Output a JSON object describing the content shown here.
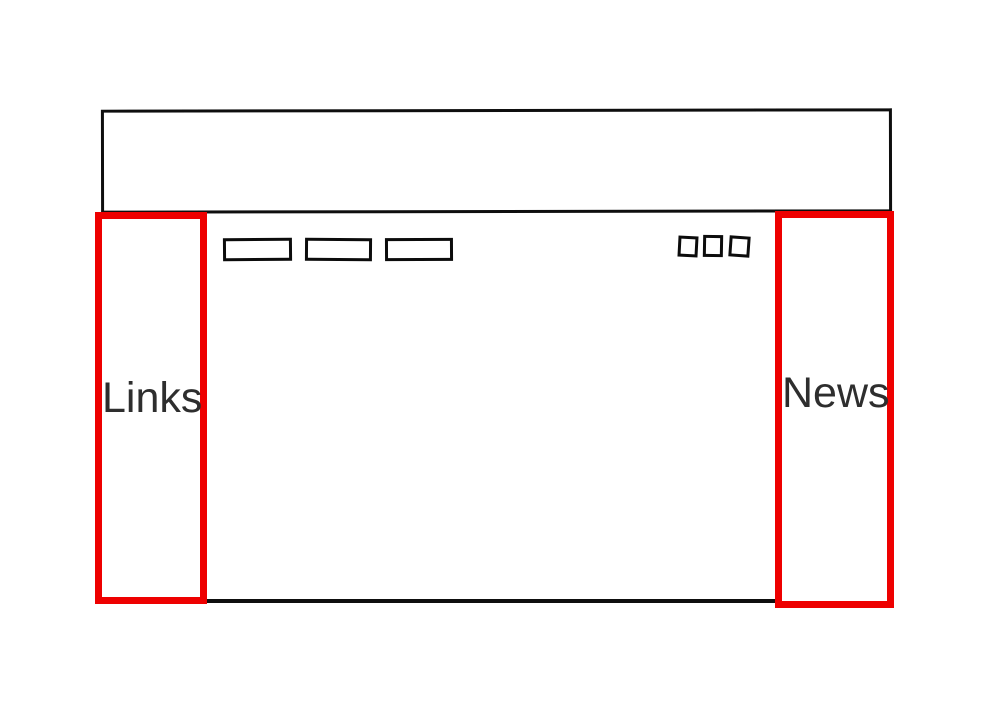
{
  "wireframe": {
    "header": {
      "content": ""
    },
    "navbar": {
      "button_count": 3,
      "buttons": [
        {
          "label": ""
        },
        {
          "label": ""
        },
        {
          "label": ""
        }
      ]
    },
    "corner_icons": {
      "square_count": 3
    },
    "sidebars": {
      "left": {
        "label": "Links"
      },
      "right": {
        "label": "News"
      }
    },
    "colors": {
      "highlight_red": "#ee0000",
      "stroke_black": "#0e0e0e",
      "label_text": "#2e2e2e",
      "background": "#ffffff"
    }
  }
}
